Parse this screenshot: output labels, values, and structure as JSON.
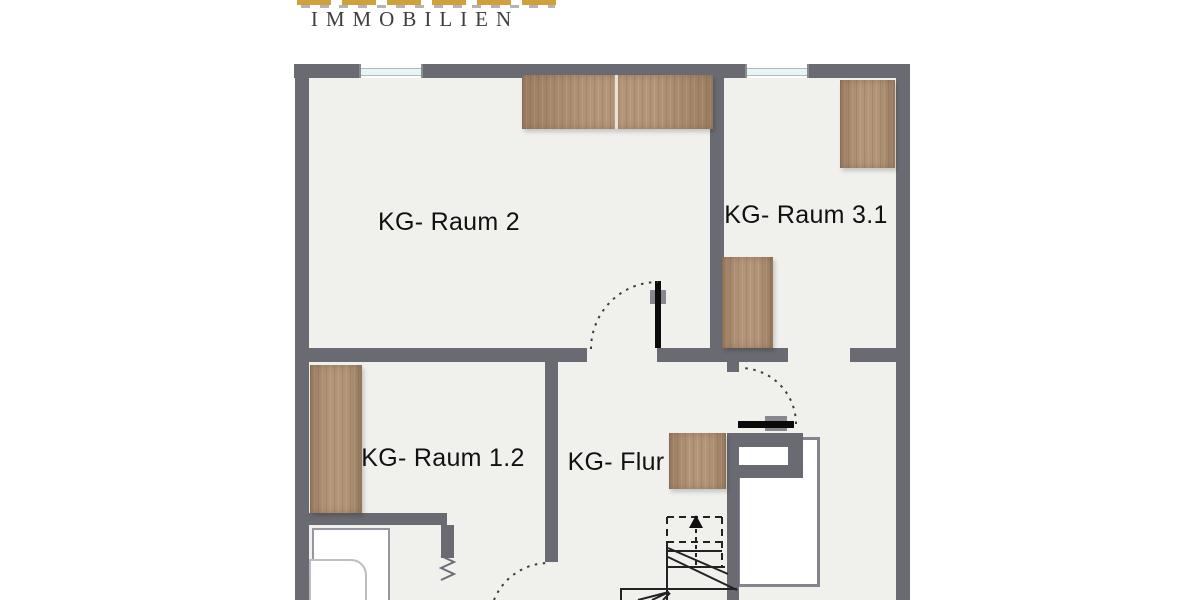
{
  "logo": {
    "immobilien": "IMMOBILIEN"
  },
  "rooms": {
    "raum2": {
      "label": "KG- Raum 2"
    },
    "raum31": {
      "label": "KG- Raum 3.1"
    },
    "raum12": {
      "label": "KG- Raum 1.2"
    },
    "flur": {
      "label": "KG- Flur"
    }
  },
  "colors": {
    "wall": "#6a6a72",
    "room_fill": "#f0f0ed",
    "wood": "#b29478",
    "wood_dark": "#9c7e62",
    "gold": "#cfa13a",
    "glazing": "#e9f4f6",
    "appliance_border": "#9596a0",
    "white_box_border": "#84848c",
    "logo_text": "#3f3f41",
    "label_text": "#111111"
  }
}
